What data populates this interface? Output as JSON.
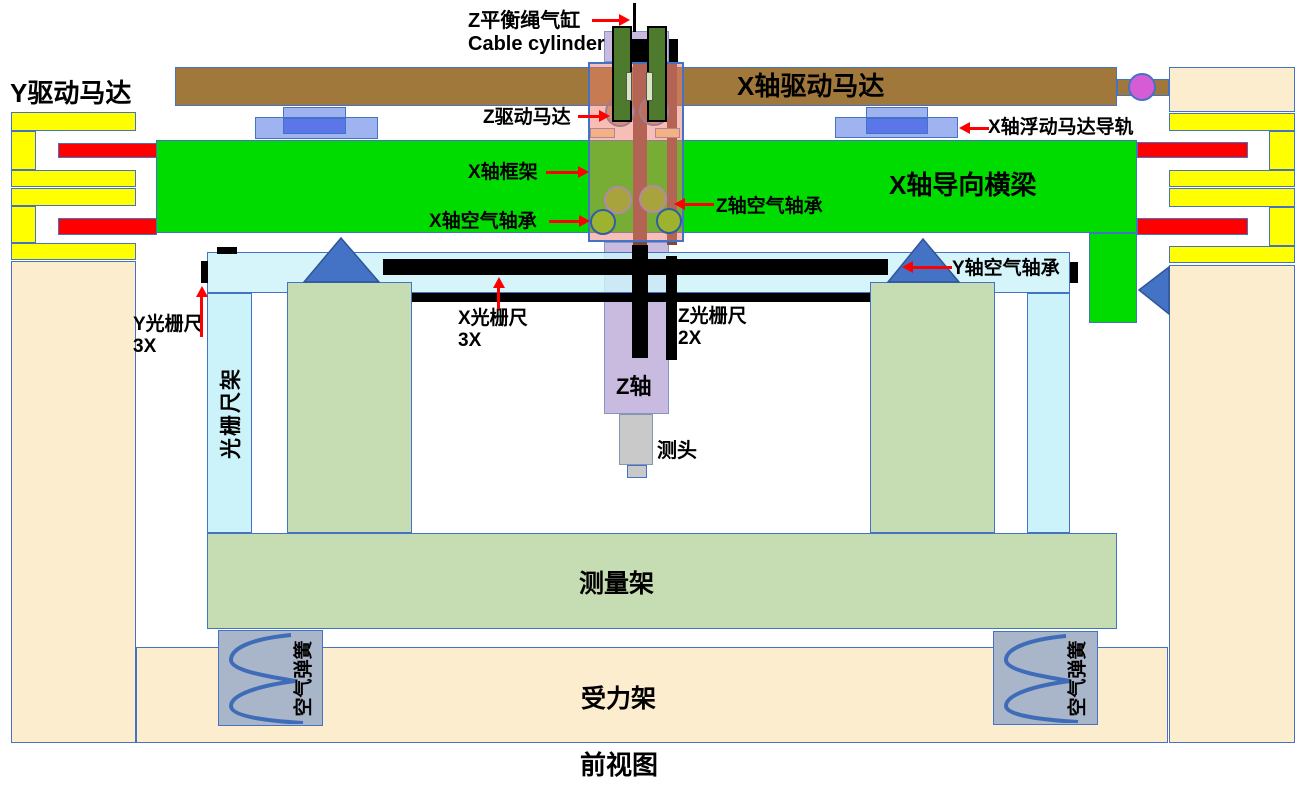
{
  "view_title": "前视图",
  "palette": {
    "beam_green": "#00DC00",
    "motor_yellow": "#FFFF00",
    "mover_red": "#FF0000",
    "beam_brown": "#A0783C",
    "rod_brown": "#7A4A3E",
    "frame_beige": "#FBEDCE",
    "scale_cyan": "#CDF3FA",
    "measuring_sage": "#C6DDB3",
    "spring_gray": "#A9B5C9",
    "outline_blue": "#4472C4",
    "triangle_blue": "#4472C4",
    "coupler_magenta": "#D55CD5",
    "z_column_purple": "#C9BBDF",
    "carriage_pink": "#ED7D69",
    "rod_green": "#4E7A2E",
    "arrow_red": "#FF0000"
  },
  "labels": {
    "z_balance_cable_cylinder_zh": "Z平衡绳气缸",
    "z_balance_cable_cylinder_en": "Cable cylinder",
    "x_drive_motor": "X轴驱动马达",
    "y_drive_motor": "Y驱动马达",
    "z_drive_motor": "Z驱动马达",
    "x_floating_motor_rail": "X轴浮动马达导轨",
    "x_frame": "X轴框架",
    "x_guide_beam": "X轴导向横梁",
    "x_air_bearing": "X轴空气轴承",
    "z_air_bearing": "Z轴空气轴承",
    "y_air_bearing": "Y轴空气轴承",
    "y_scale": "Y光栅尺",
    "y_scale_qty": "3X",
    "x_scale": "X光栅尺",
    "x_scale_qty": "3X",
    "z_scale": "Z光栅尺",
    "z_scale_qty": "2X",
    "scale_frame": "光栅尺架",
    "z_axis": "Z轴",
    "probe": "测头",
    "measuring_frame": "测量架",
    "air_spring": "空气弹簧",
    "force_frame": "受力架"
  }
}
